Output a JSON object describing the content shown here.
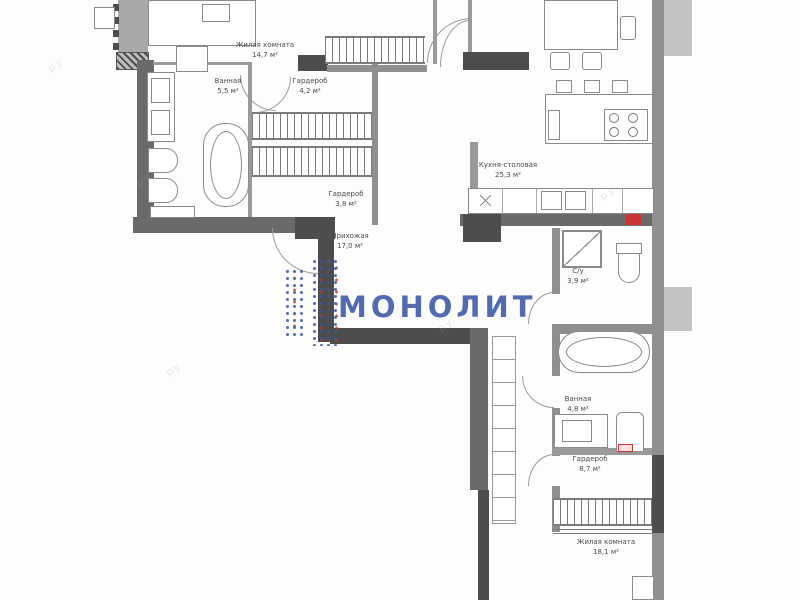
{
  "watermark": {
    "text": "МОНОЛИТ",
    "ghost": "ру",
    "accent_blue": "#3a57a8",
    "accent_red": "#c0392b"
  },
  "rooms": [
    {
      "id": "living-room-top",
      "name": "Жилая комната",
      "area": "14,7 м²"
    },
    {
      "id": "bathroom-left",
      "name": "Ванная",
      "area": "5,5 м²"
    },
    {
      "id": "wardrobe-top",
      "name": "Гардероб",
      "area": "4,2 м²"
    },
    {
      "id": "wardrobe-mid",
      "name": "Гардероб",
      "area": "3,8 м²"
    },
    {
      "id": "hallway",
      "name": "Прихожая",
      "area": "17,0 м²"
    },
    {
      "id": "kitchen-dining",
      "name": "Кухня-столовая",
      "area": "25,3 м²"
    },
    {
      "id": "wc",
      "name": "С/у",
      "area": "3,9 м²"
    },
    {
      "id": "bathroom-right",
      "name": "Ванная",
      "area": "4,8 м²"
    },
    {
      "id": "wardrobe-bottom",
      "name": "Гардероб",
      "area": "8,7 м²"
    },
    {
      "id": "living-room-bottom",
      "name": "Жилая комната",
      "area": "18,1 м²"
    }
  ]
}
